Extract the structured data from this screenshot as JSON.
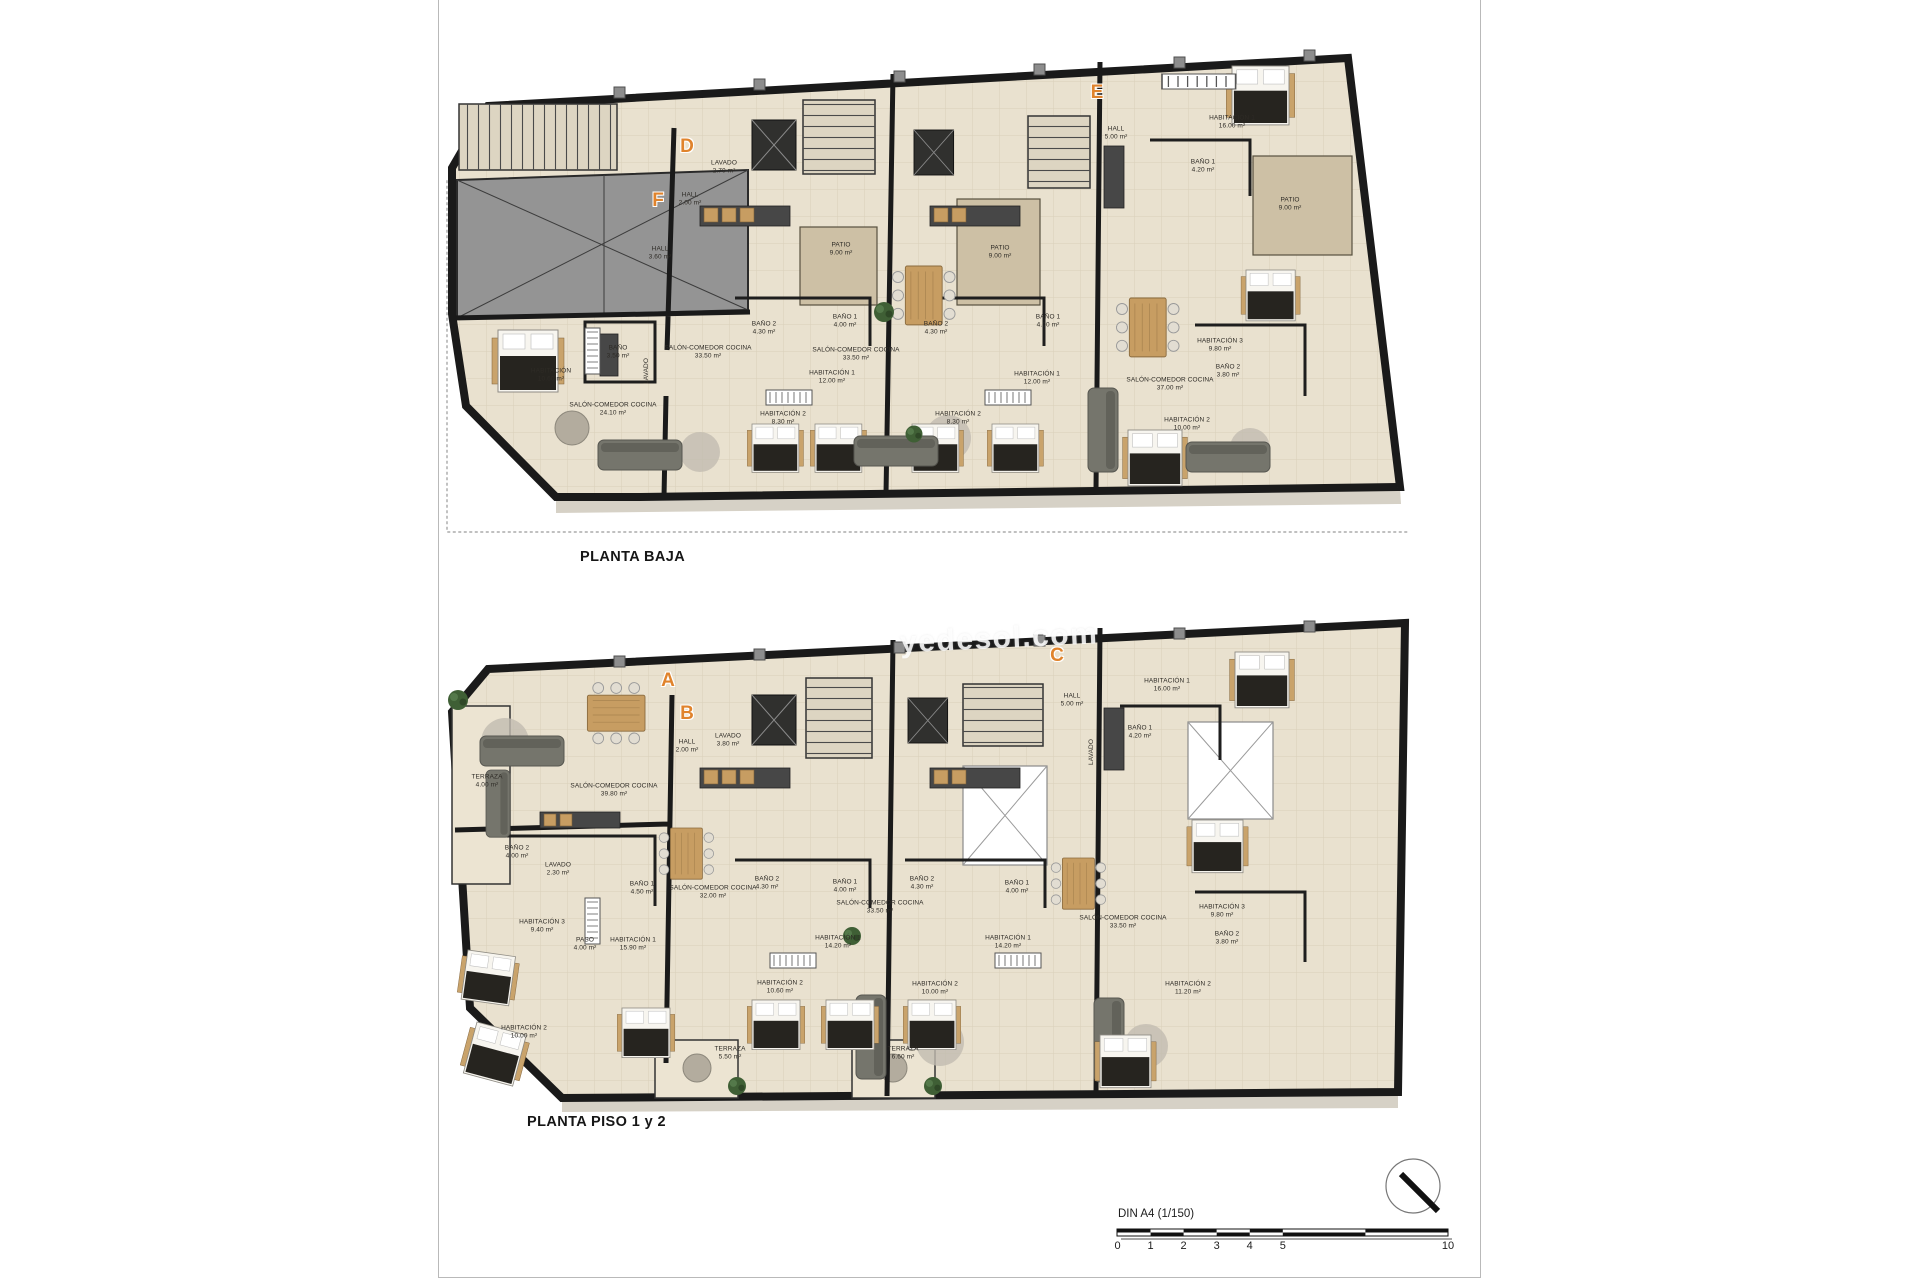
{
  "watermark": {
    "text": "yedesol.com"
  },
  "plans": [
    {
      "id": "planta-baja",
      "title": "PLANTA BAJA",
      "letters": [
        {
          "label": "F",
          "x": 658,
          "y": 201
        },
        {
          "label": "D",
          "x": 687,
          "y": 147
        },
        {
          "label": "E",
          "x": 1097,
          "y": 93
        }
      ],
      "rooms": [
        {
          "name": "HALL",
          "area": "3.60 m²",
          "x": 660,
          "y": 253
        },
        {
          "name": "BAÑO",
          "area": "3.50 m²",
          "x": 618,
          "y": 352
        },
        {
          "name": "LAVADO",
          "area": "",
          "x": 647,
          "y": 371,
          "vertical": true
        },
        {
          "name": "HABITACIÓN",
          "area": "10.60 m²",
          "x": 551,
          "y": 375
        },
        {
          "name": "SALÓN-COMEDOR COCINA",
          "area": "24.10 m²",
          "x": 613,
          "y": 409
        },
        {
          "name": "HALL",
          "area": "2.00 m²",
          "x": 690,
          "y": 199
        },
        {
          "name": "LAVADO",
          "area": "2.70 m²",
          "x": 724,
          "y": 167
        },
        {
          "name": "SALÓN-COMEDOR COCINA",
          "area": "33.50 m²",
          "x": 708,
          "y": 352
        },
        {
          "name": "BAÑO 2",
          "area": "4.30 m²",
          "x": 764,
          "y": 328
        },
        {
          "name": "BAÑO 1",
          "area": "4.00 m²",
          "x": 845,
          "y": 321
        },
        {
          "name": "HABITACIÓN 1",
          "area": "12.00 m²",
          "x": 832,
          "y": 377
        },
        {
          "name": "HABITACIÓN 2",
          "area": "8.30 m²",
          "x": 783,
          "y": 418
        },
        {
          "name": "SALÓN-COMEDOR COCINA",
          "area": "33.50 m²",
          "x": 856,
          "y": 354
        },
        {
          "name": "BAÑO 2",
          "area": "4.30 m²",
          "x": 936,
          "y": 328
        },
        {
          "name": "BAÑO 1",
          "area": "4.00 m²",
          "x": 1048,
          "y": 321
        },
        {
          "name": "HABITACIÓN 1",
          "area": "12.00 m²",
          "x": 1037,
          "y": 378
        },
        {
          "name": "HABITACIÓN 2",
          "area": "8.30 m²",
          "x": 958,
          "y": 418
        },
        {
          "name": "PATIO",
          "area": "9.00 m²",
          "x": 841,
          "y": 249
        },
        {
          "name": "PATIO",
          "area": "9.00 m²",
          "x": 1000,
          "y": 252
        },
        {
          "name": "PATIO",
          "area": "9.00 m²",
          "x": 1290,
          "y": 204
        },
        {
          "name": "HALL",
          "area": "5.00 m²",
          "x": 1116,
          "y": 133
        },
        {
          "name": "HABITACIÓN 1",
          "area": "16.00 m²",
          "x": 1232,
          "y": 122
        },
        {
          "name": "BAÑO 1",
          "area": "4.20 m²",
          "x": 1203,
          "y": 166
        },
        {
          "name": "SALÓN-COMEDOR COCINA",
          "area": "37.00 m²",
          "x": 1170,
          "y": 384
        },
        {
          "name": "HABITACIÓN 3",
          "area": "9.80 m²",
          "x": 1220,
          "y": 345
        },
        {
          "name": "BAÑO 2",
          "area": "3.80 m²",
          "x": 1228,
          "y": 371
        },
        {
          "name": "HABITACIÓN 2",
          "area": "10.00 m²",
          "x": 1187,
          "y": 424
        }
      ]
    },
    {
      "id": "planta-piso-1-y-2",
      "title": "PLANTA PISO 1 y 2",
      "letters": [
        {
          "label": "A",
          "x": 668,
          "y": 681
        },
        {
          "label": "B",
          "x": 687,
          "y": 714
        },
        {
          "label": "C",
          "x": 1057,
          "y": 656
        }
      ],
      "rooms": [
        {
          "name": "TERRAZA",
          "area": "4.00 m²",
          "x": 487,
          "y": 781
        },
        {
          "name": "SALÓN-COMEDOR COCINA",
          "area": "39.80 m²",
          "x": 614,
          "y": 790
        },
        {
          "name": "BAÑO 2",
          "area": "4.00 m²",
          "x": 517,
          "y": 852
        },
        {
          "name": "LAVADO",
          "area": "2.30 m²",
          "x": 558,
          "y": 869
        },
        {
          "name": "BAÑO 1",
          "area": "4.50 m²",
          "x": 642,
          "y": 888
        },
        {
          "name": "HABITACIÓN 3",
          "area": "9.40 m²",
          "x": 542,
          "y": 926
        },
        {
          "name": "PASO",
          "area": "4.00 m²",
          "x": 585,
          "y": 944
        },
        {
          "name": "HABITACIÓN 1",
          "area": "15.90 m²",
          "x": 633,
          "y": 944
        },
        {
          "name": "HABITACIÓN 2",
          "area": "10.00 m²",
          "x": 524,
          "y": 1032
        },
        {
          "name": "HALL",
          "area": "2.00 m²",
          "x": 687,
          "y": 746
        },
        {
          "name": "LAVADO",
          "area": "3.80 m²",
          "x": 728,
          "y": 740
        },
        {
          "name": "SALÓN-COMEDOR COCINA",
          "area": "32.00 m²",
          "x": 713,
          "y": 892
        },
        {
          "name": "BAÑO 2",
          "area": "4.30 m²",
          "x": 767,
          "y": 883
        },
        {
          "name": "BAÑO 1",
          "area": "4.00 m²",
          "x": 845,
          "y": 886
        },
        {
          "name": "HABITACIÓN 1",
          "area": "14.20 m²",
          "x": 838,
          "y": 942
        },
        {
          "name": "HABITACIÓN 2",
          "area": "10.60 m²",
          "x": 780,
          "y": 987
        },
        {
          "name": "TERRAZA",
          "area": "5.50 m²",
          "x": 730,
          "y": 1053
        },
        {
          "name": "SALÓN-COMEDOR COCINA",
          "area": "33.50 m²",
          "x": 880,
          "y": 907
        },
        {
          "name": "BAÑO 2",
          "area": "4.30 m²",
          "x": 922,
          "y": 883
        },
        {
          "name": "BAÑO 1",
          "area": "4.00 m²",
          "x": 1017,
          "y": 887
        },
        {
          "name": "HABITACIÓN 1",
          "area": "14.20 m²",
          "x": 1008,
          "y": 942
        },
        {
          "name": "HABITACIÓN 2",
          "area": "10.00 m²",
          "x": 935,
          "y": 988
        },
        {
          "name": "TERRAZA",
          "area": "6.60 m²",
          "x": 903,
          "y": 1053
        },
        {
          "name": "HALL",
          "area": "5.00 m²",
          "x": 1072,
          "y": 700
        },
        {
          "name": "LAVADO",
          "area": "",
          "x": 1092,
          "y": 752,
          "vertical": true
        },
        {
          "name": "HABITACIÓN 1",
          "area": "16.00 m²",
          "x": 1167,
          "y": 685
        },
        {
          "name": "BAÑO 1",
          "area": "4.20 m²",
          "x": 1140,
          "y": 732
        },
        {
          "name": "SALÓN-COMEDOR COCINA",
          "area": "33.50 m²",
          "x": 1123,
          "y": 922
        },
        {
          "name": "HABITACIÓN 3",
          "area": "9.80 m²",
          "x": 1222,
          "y": 911
        },
        {
          "name": "BAÑO 2",
          "area": "3.80 m²",
          "x": 1227,
          "y": 938
        },
        {
          "name": "HABITACIÓN 2",
          "area": "11.20 m²",
          "x": 1188,
          "y": 988
        }
      ]
    }
  ],
  "scale_bar": {
    "label": "DIN A4 (1/150)",
    "ticks": [
      {
        "label": "0",
        "u": 0
      },
      {
        "label": "1",
        "u": 1
      },
      {
        "label": "2",
        "u": 2
      },
      {
        "label": "3",
        "u": 3
      },
      {
        "label": "4",
        "u": 4
      },
      {
        "label": "5",
        "u": 5
      },
      {
        "label": "10",
        "u": 10
      }
    ]
  },
  "colors": {
    "floor": "#e9e1cf",
    "wall": "#1a1a1a",
    "patio": "#cdc0a5",
    "terrace": "#ece4d2",
    "garage": "#949494",
    "unit_letter": "#e0832c",
    "wood": "#c79d62"
  }
}
